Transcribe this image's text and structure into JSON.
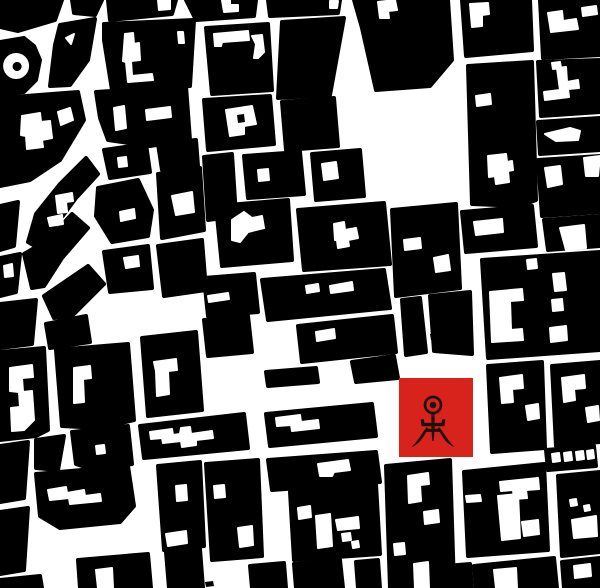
{
  "artwork": {
    "description": "figure-ground city map with red marker square",
    "palette": {
      "background": "#ffffff",
      "ink": "#000000",
      "marker_red": "#d7231b",
      "symbol_color": "#200f08"
    },
    "marker": {
      "x": 399,
      "y": 378,
      "width": 74,
      "height": 79,
      "symbol": "einstuerzende-neubauten-man"
    },
    "logo": {
      "head_circle": {
        "cx": 433,
        "cy": 405,
        "r": 8,
        "stroke_width": 2.7
      },
      "eye_dot": {
        "cx": 433,
        "cy": 405,
        "r": 3.3
      },
      "paths": [
        "M431.7,413 L434.3,413 L434.3,424 L431.7,424 Z",
        "M421,419.5 L423.6,419.5 L424.2,423.2 L441.8,423.2 L442.4,419.5 L445,419.5 L444.2,426 L421.8,426 Z",
        "M425.5,429 L440.5,429 L440,431.6 L426,431.6 Z",
        "M431.6,426 L434.4,426 L433.6,440.5 L432.4,440.5 Z",
        "M427,427.5 C422,433 421,437.5 412.5,446.5 C419,443 422.5,438.5 426.5,431 L427.6,428.4 Z",
        "M439,427.5 C444,433 445,437.5 453.5,446.5 C447,443 443.5,438.5 439.5,431 L438.4,428.4 Z"
      ]
    },
    "map": {
      "blocks": [
        "M0,0 L62,0 L55,20 L18,31 L0,27 Z",
        "M72,0 L102,0 L95,15 L74,13 Z",
        "M60,25 L95,19 L88,60 L70,85 L50,86 L55,45 Z",
        "M0,42 L24,38 L34,46 L40,60 L36,80 L24,92 L0,95 Z",
        "M108,0 L176,0 L172,14 L110,20 Z",
        "M186,0 L256,0 L254,16 L196,20 Z",
        "M268,0 L340,0 L338,13 L270,16 Z",
        "M104,24 L194,20 L190,86 L112,90 L104,40 Z",
        "M206,28 L268,24 L272,90 L212,94 Z",
        "M282,22 L344,18 L330,95 L278,98 Z",
        "M354,0 L448,0 L452,60 L430,86 L376,90 L362,28 Z",
        "M462,0 L530,0 L532,50 L466,56 Z",
        "M540,0 L600,0 L600,55 L543,58 Z",
        "M468,66 L532,62 L536,200 L520,206 L472,204 Z",
        "M538,62 L600,60 L600,112 L541,116 Z",
        "M538,122 L600,118 L600,150 L540,154 Z",
        "M538,160 L600,156 L600,212 L542,216 Z",
        "M544,220 L600,216 L600,246 L548,250 Z",
        "M482,260 L600,252 L600,350 L488,358 Z",
        "M462,212 L532,206 L536,246 L466,252 Z",
        "M0,98 L78,92 L84,120 L60,160 L30,180 L0,186 Z",
        "M96,92 L186,86 L190,140 L150,146 L108,140 L100,118 Z",
        "M104,150 L146,144 L150,172 L110,178 Z",
        "M158,144 L196,140 L198,166 L162,170 Z",
        "M98,188 L138,180 L152,210 L148,236 L112,242 L96,216 Z",
        "M158,174 L200,168 L204,230 L162,238 Z",
        "M36,214 L60,184 L86,158 L98,174 L76,198 L54,228 L42,250 L28,242 Z",
        "M0,206 L18,202 L14,246 L0,250 Z",
        "M0,258 L20,254 L16,292 L0,296 Z",
        "M24,254 L48,240 L72,214 L88,228 L62,258 L44,286 L32,288 Z",
        "M104,252 L148,246 L152,288 L110,292 Z",
        "M158,246 L202,240 L206,290 L164,296 Z",
        "M44,296 L88,266 L104,284 L72,316 L54,318 Z",
        "M0,304 L36,300 L32,344 L0,348 Z",
        "M46,324 L86,316 L90,342 L50,348 Z",
        "M204,100 L270,96 L274,144 L208,150 Z",
        "M282,102 L334,98 L338,146 L286,150 Z",
        "M204,157 L232,154 L236,216 L208,220 Z",
        "M244,156 L300,152 L304,194 L248,198 Z",
        "M312,154 L360,150 L364,196 L316,200 Z",
        "M216,206 L288,200 L292,260 L222,266 Z",
        "M298,210 L384,203 L390,264 L304,270 Z",
        "M392,210 L456,204 L460,288 L396,296 Z",
        "M262,280 L384,270 L390,308 L268,320 Z",
        "M204,278 L254,274 L258,312 L208,316 Z",
        "M204,320 L248,316 L252,352 L208,356 Z",
        "M298,326 L392,316 L396,352 L302,362 Z",
        "M352,362 L394,356 L398,378 L356,382 Z",
        "M402,300 L420,298 L426,352 L406,355 Z",
        "M430,296 L470,292 L472,354 L434,351 Z",
        "M266,372 L316,368 L318,382 L268,386 Z",
        "M0,352 L44,348 L48,430 L36,436 L0,440 Z",
        "M56,350 L128,344 L134,420 L100,428 L62,426 Z",
        "M142,338 L196,332 L202,410 L148,416 Z",
        "M36,440 L64,436 L58,470 L36,468 Z",
        "M72,432 L128,426 L132,464 L94,470 L76,464 Z",
        "M0,446 L28,442 L24,498 L0,502 Z",
        "M140,426 L244,414 L248,448 L144,458 Z",
        "M266,414 L372,404 L376,436 L270,446 Z",
        "M268,460 L376,452 L380,482 L272,490 Z",
        "M36,474 L128,466 L134,506 L120,522 L60,528 L40,516 Z",
        "M158,466 L200,462 L204,546 L164,550 Z",
        "M206,464 L258,460 L262,556 L212,560 Z",
        "M290,492 L376,484 L380,554 L294,560 Z",
        "M386,466 L450,460 L454,586 L390,588 Z",
        "M464,472 L544,464 L548,550 L468,556 Z",
        "M558,476 L600,472 L600,552 L562,556 Z",
        "M488,366 L542,362 L545,448 L492,452 Z",
        "M552,366 L600,362 L600,442 L556,446 Z",
        "M546,450 L594,446 L596,466 L548,470 Z",
        "M78,560 L148,554 L151,588 L80,588 Z",
        "M166,552 L200,549 L203,588 L169,588 Z",
        "M250,566 L284,563 L286,588 L252,588 Z",
        "M294,564 L340,560 L343,588 L296,588 Z",
        "M356,562 L378,560 L380,588 L358,588 Z",
        "M446,566 L470,564 L472,588 L448,588 Z",
        "M474,566 L554,558 L557,588 L476,588 Z",
        "M562,562 L600,558 L600,588 L564,588 Z",
        "M0,512 L28,508 L24,570 L0,574 Z",
        "M0,580 L40,576 L42,588 L0,588 Z"
      ],
      "courtyards": [
        "M16,54 a12,12 0 1 0 0.2,0 Z",
        "M125,34 L133,33 L134,44 L139,43 L140,60 L131,61 L132,76 L152,74 L153,80 L128,82 L126,62 L123,61 Z",
        "M178,32 L183,32 L184,43 L179,43 Z",
        "M158,0 L170,0 L170,9 L159,10 Z",
        "M222,0 L230,0 L230,5 L238,5 L238,11 L224,12 L223,6 Z",
        "M330,1 L338,1 L337,8 L330,8 Z",
        "M214,34 L248,31 L249,40 L222,42 L221,46 L215,46 Z",
        "M252,36 L262,35 L264,52 L258,58 L254,58 L256,44 Z",
        "M378,2 L395,0 L397,10 L388,11 L389,18 L380,18 Z",
        "M470,4 L488,3 L489,14 L482,15 L482,26 L472,27 Z",
        "M548,13 L562,11 L563,21 L576,19 L578,29 L551,32 Z",
        "M582,8 L596,6 L597,14 L583,16 Z",
        "M488,156 L506,154 L507,162 L512,161 L513,170 L508,171 L509,182 L496,184 L495,176 L489,177 Z",
        "M476,96 L490,94 L491,104 L477,106 Z",
        "M557,68 L566,67 L567,82 L578,80 L579,88 L568,89 L569,97 L545,100 L544,92 L560,90 Z",
        "M552,63 L560,62 L561,68 L553,69 Z",
        "M545,134 L570,128 L580,131 L578,140 L556,141 Z",
        "M545,168 L560,166 L562,184 L548,187 Z",
        "M584,158 L600,156 L598,176 L586,176 Z",
        "M560,228 L584,225 L586,248 L566,250 Z",
        "M490,292 L522,289 L523,300 L510,301 L511,330 L522,329 L523,340 L492,342 Z",
        "M527,260 L536,259 L537,268 L528,269 Z",
        "M553,274 L564,273 L566,290 L555,291 Z",
        "M552,300 L562,299 L563,310 L553,311 Z",
        "M550,328 L566,326 L567,340 L551,342 Z",
        "M474,222 L502,219 L503,232 L476,235 Z",
        "M22,116 L40,113 L41,122 L50,121 L52,138 L42,140 L43,147 L27,149 L26,136 L21,135 Z",
        "M58,112 L70,108 L73,120 L61,125 Z",
        "M114,108 L124,106 L126,128 L116,130 Z",
        "M146,110 L170,107 L171,117 L147,120 Z",
        "M120,212 L134,209 L135,218 L121,221 Z",
        "M172,196 L192,192 L194,212 L176,215 Z",
        "M56,196 L72,193 L73,201 L66,202 L67,212 L58,213 Z",
        "M48,218 L62,215 L63,224 L50,226 Z",
        "M4,266 L12,264 L13,276 L5,277 Z",
        "M124,258 L138,256 L139,266 L126,268 Z",
        "M118,158 L126,157 L127,166 L119,167 Z",
        "M226,110 L252,106 L256,124 L244,126 L244,134 L230,136 Z",
        "M258,170 L268,169 L269,180 L259,181 Z",
        "M322,164 L336,162 L338,178 L324,180 Z",
        "M232,220 L244,212 L252,218 L262,216 L264,228 L248,232 L240,242 L232,240 Z",
        "M334,224 L344,222 L345,230 L356,228 L358,238 L348,240 L349,246 L338,248 L337,240 L335,240 Z",
        "M404,240 L420,238 L421,248 L405,250 Z",
        "M434,258 L448,255 L450,270 L436,272 Z",
        "M306,286 L318,284 L319,291 L307,293 Z",
        "M330,286 L352,282 L353,290 L331,293 Z",
        "M208,296 L228,293 L229,299 L209,302 Z",
        "M316,332 L334,329 L335,338 L317,341 Z",
        "M10,368 L32,365 L33,377 L22,378 L23,392 L32,391 L34,420 L24,430 L12,431 L11,408 L20,407 L19,392 L10,391 Z",
        "M74,368 L90,366 L91,378 L83,379 L84,402 L74,403 Z",
        "M154,362 L176,359 L177,370 L168,371 L169,394 L157,396 L156,371 Z",
        "M96,446 L104,445 L105,453 L97,454 Z",
        "M150,432 L172,429 L173,435 L180,434 L181,428 L190,427 L191,434 L212,431 L213,438 L196,440 L196,445 L182,447 L181,441 L163,443 L162,438 L151,439 Z",
        "M276,418 L300,415 L301,422 L318,420 L319,428 L292,431 L291,425 L277,426 Z",
        "M318,464 L348,460 L350,470 L334,472 L332,476 L320,476 Z",
        "M48,490 L66,487 L67,493 L84,490 L85,496 L100,494 L101,501 L70,504 L69,498 L50,500 Z",
        "M176,486 L186,485 L187,500 L177,501 Z",
        "M166,534 L186,531 L187,543 L168,546 Z",
        "M214,486 L224,485 L225,497 L215,498 Z",
        "M238,528 L252,526 L253,545 L240,547 Z",
        "M316,516 L330,514 L332,546 L318,548 Z",
        "M298,508 L310,506 L311,517 L299,519 Z",
        "M336,520 L358,517 L359,528 L338,530 Z",
        "M342,534 l8,-1 1,7 -8,1 Z",
        "M352,542 l6,-1 1,6 -6,1 Z",
        "M408,476 L428,473 L429,484 L420,485 L421,501 L409,503 Z",
        "M424,512 L438,510 L439,522 L425,524 Z",
        "M394,544 L404,543 L405,554 L395,555 Z",
        "M414,564 L428,562 L429,588 L415,588 Z",
        "M500,482 L538,478 L539,489 L526,490 L527,498 L514,499 L513,490 L501,491 Z",
        "M498,496 L518,494 L520,538 L502,540 Z",
        "M522,522 L538,520 L539,534 L524,536 Z",
        "M466,496 L480,495 L481,501 L467,502 Z",
        "M572,520 L596,516 L597,536 L574,538 Z",
        "M570,500 l6,-1 1,6 -6,1 Z",
        "M584,506 l5,-1 1,5 -5,1 Z",
        "M500,378 L522,375 L523,388 L512,389 L513,402 L502,403 Z",
        "M526,406 L538,404 L539,418 L528,420 Z",
        "M562,378 L584,375 L585,388 L574,389 L575,400 L564,402 Z",
        "M586,408 L598,406 L599,420 L588,422 Z",
        "M552,454 l7,-1 1,8 -7,1 Z",
        "M564,453 l7,-1 1,8 -7,1 Z",
        "M576,452 l7,-1 1,8 -7,1 Z",
        "M587,451 l6,-1 1,8 -6,1 Z",
        "M96,570 L112,568 L113,588 L98,588 Z",
        "M494,570 L516,568 L517,588 L496,588 Z",
        "M574,566 L590,564 L591,576 L575,578 Z",
        "M66,38 L74,34 L71,44 Z"
      ],
      "specks": [
        "M17,62 a4.5,4.5 0 1 0 0.2,0 Z",
        "M237,115 l7,-1 1,8 -7,1 Z",
        "M205,582 l8,-1 1,5 -8,1 Z",
        "M430,334 l6,-1 1,6 -6,1 Z"
      ]
    }
  }
}
